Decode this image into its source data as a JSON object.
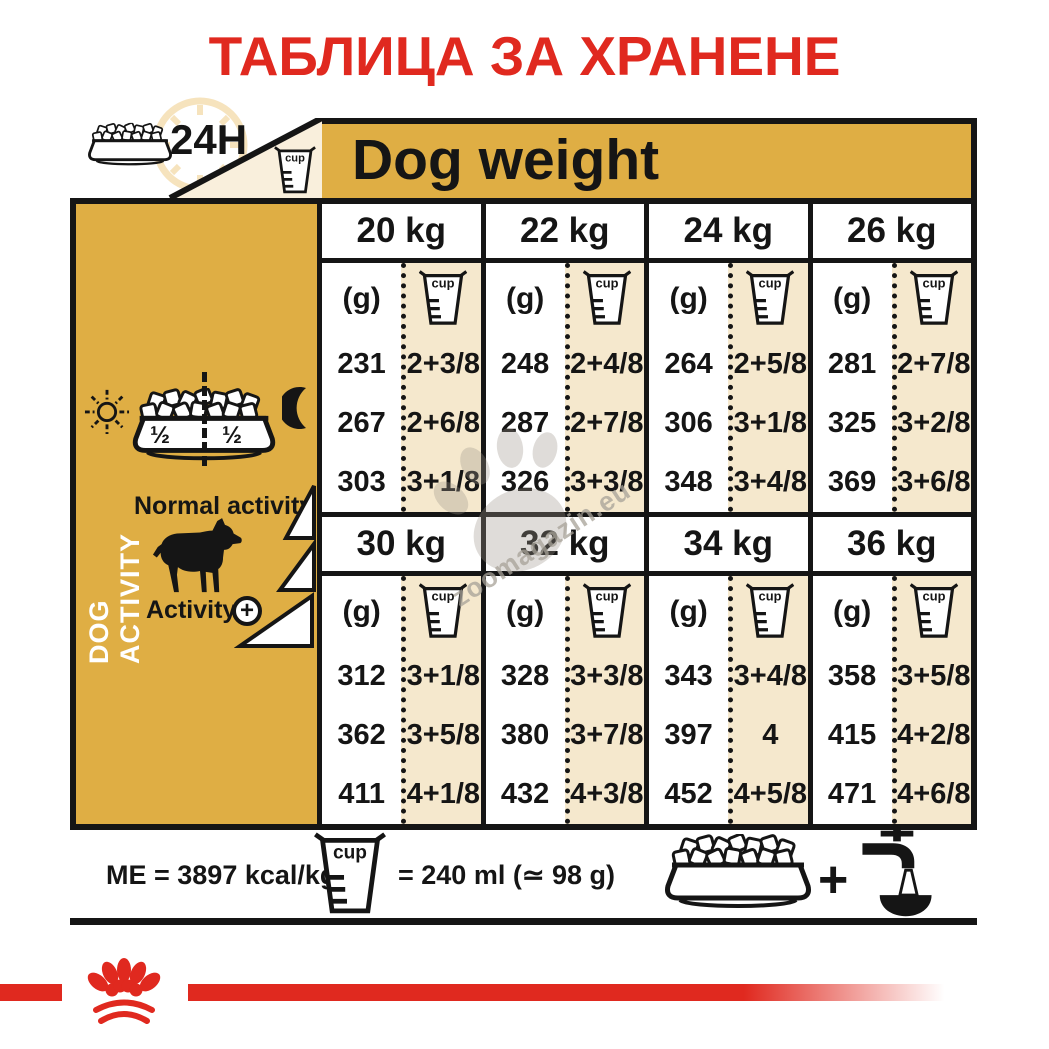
{
  "title": "ТАБЛИЦА ЗА ХРАНЕНЕ",
  "top": {
    "per_day": "24H"
  },
  "chart_data": {
    "type": "table",
    "title": "ТАБЛИЦА ЗА ХРАНЕНЕ",
    "header": "Dog weight",
    "unit_grams": "(g)",
    "unit_cup": "cup",
    "cup_note": "= 240 ml (≃ 98 g)",
    "energy": "ME = 3897 kcal/kg",
    "activity_rows": [
      "Normal activity",
      "medium activity",
      "Activity +"
    ],
    "blocks": [
      {
        "weights": [
          "20 kg",
          "22 kg",
          "24 kg",
          "26 kg"
        ],
        "columns": [
          {
            "grams": [
              "231",
              "267",
              "303"
            ],
            "cups": [
              "2+3/8",
              "2+6/8",
              "3+1/8"
            ]
          },
          {
            "grams": [
              "248",
              "287",
              "326"
            ],
            "cups": [
              "2+4/8",
              "2+7/8",
              "3+3/8"
            ]
          },
          {
            "grams": [
              "264",
              "306",
              "348"
            ],
            "cups": [
              "2+5/8",
              "3+1/8",
              "3+4/8"
            ]
          },
          {
            "grams": [
              "281",
              "325",
              "369"
            ],
            "cups": [
              "2+7/8",
              "3+2/8",
              "3+6/8"
            ]
          }
        ]
      },
      {
        "weights": [
          "30 kg",
          "32 kg",
          "34 kg",
          "36 kg"
        ],
        "columns": [
          {
            "grams": [
              "312",
              "362",
              "411"
            ],
            "cups": [
              "3+1/8",
              "3+5/8",
              "4+1/8"
            ]
          },
          {
            "grams": [
              "328",
              "380",
              "432"
            ],
            "cups": [
              "3+3/8",
              "3+7/8",
              "4+3/8"
            ]
          },
          {
            "grams": [
              "343",
              "397",
              "452"
            ],
            "cups": [
              "3+4/8",
              "4",
              "4+5/8"
            ]
          },
          {
            "grams": [
              "358",
              "415",
              "471"
            ],
            "cups": [
              "3+5/8",
              "4+2/8",
              "4+6/8"
            ]
          }
        ]
      }
    ]
  },
  "sidebar": {
    "label": "DOG ACTIVITY",
    "bowl_half_left": "½",
    "bowl_half_right": "½",
    "normal_activity": "Normal activity",
    "activity": "Activity",
    "activity_plus": "+"
  },
  "footer": {
    "energy": "ME = 3897 kcal/kg",
    "cup_equals": "= 240 ml (≃ 98 g)",
    "plus": "+"
  },
  "watermark": "zoomagazin.eu",
  "colors": {
    "gold": "#dfae44",
    "beige": "#f5e8cd",
    "triangle_beige": "#f9efdc",
    "red": "#e0291f",
    "black": "#151515",
    "clock": "#f6e3bd"
  }
}
